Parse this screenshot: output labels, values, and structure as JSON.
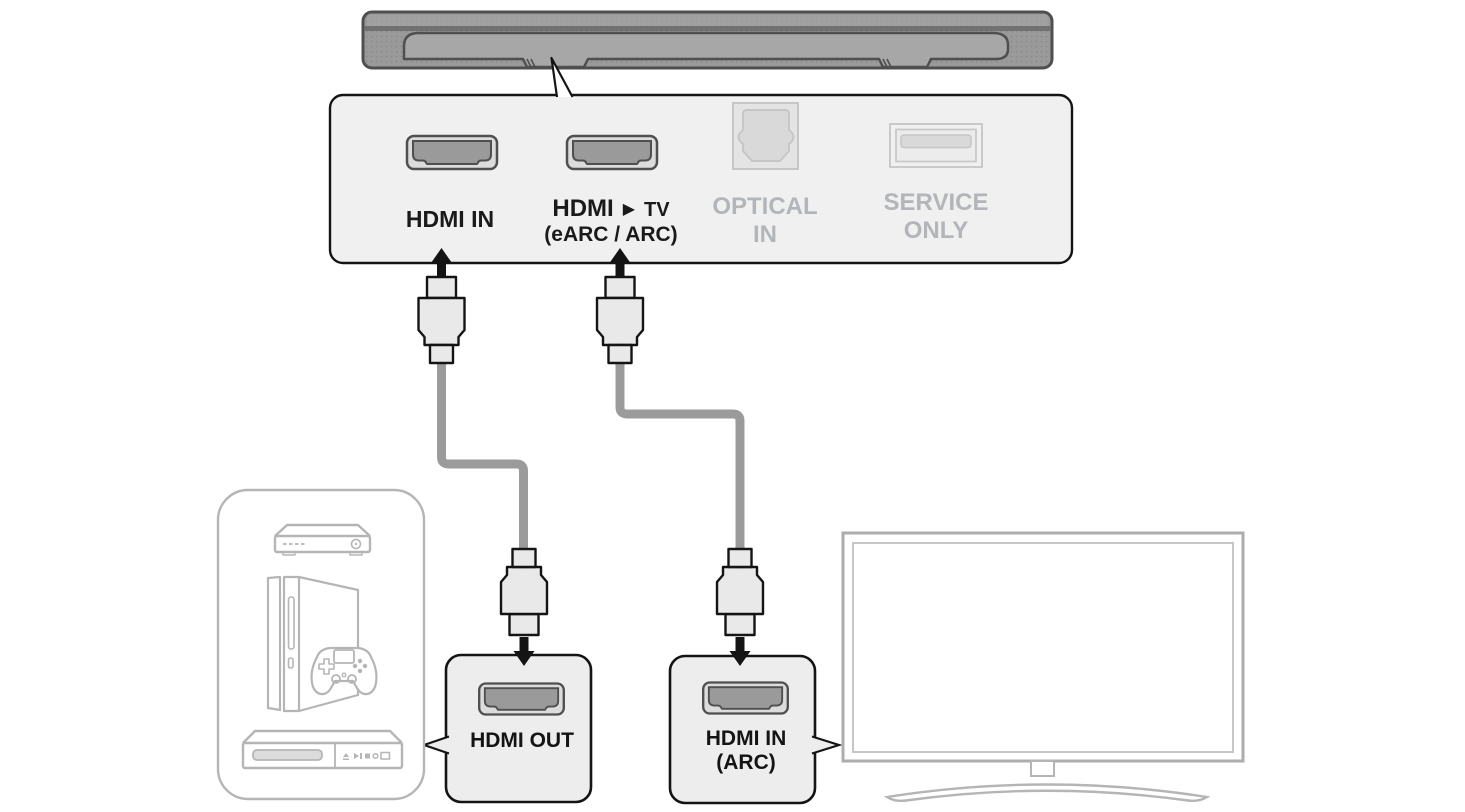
{
  "panel": {
    "ports": [
      {
        "name": "hdmi-in",
        "label": "HDMI IN"
      },
      {
        "name": "hdmi-tv-earc-arc",
        "label_prefix": "HDMI",
        "label_arrow": "▶",
        "label_suffix": "TV",
        "sublabel": "(eARC / ARC)"
      },
      {
        "name": "optical-in",
        "label_line1": "OPTICAL",
        "label_line2": "IN"
      },
      {
        "name": "service-usb",
        "label_line1": "SERVICE",
        "label_line2": "ONLY"
      }
    ]
  },
  "endpoints": {
    "hdmi_out": {
      "label": "HDMI OUT"
    },
    "hdmi_in_arc": {
      "label_line1": "HDMI IN",
      "label_line2": "(ARC)"
    }
  },
  "colors": {
    "label_dark": "#1a1a1a",
    "label_ghost": "#b2b5b9",
    "outline_dark": "#141414",
    "device_outline": "#b5b5b5",
    "cable": "#9b9b9b",
    "panel_fill": "#f0f0f0",
    "soundbar_fill": "#9a9a9a"
  }
}
